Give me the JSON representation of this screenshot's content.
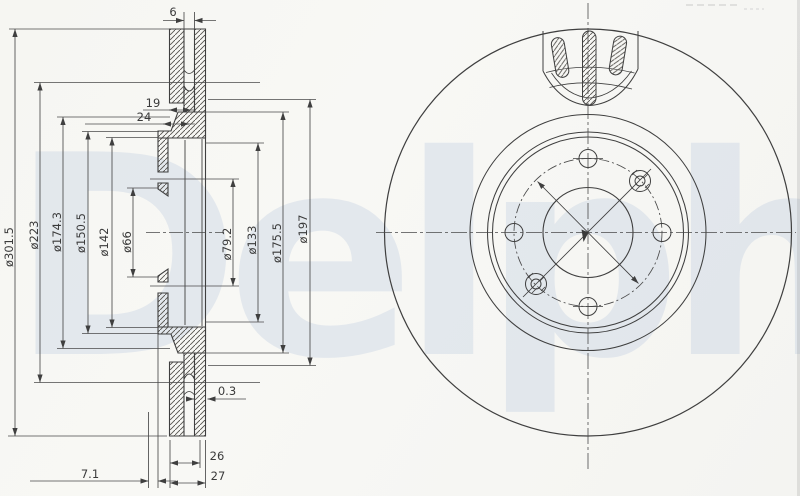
{
  "watermark": {
    "text": "Delphi",
    "color": "#bccadf"
  },
  "section_view": {
    "left_dims": [
      "ø301.5",
      "ø223",
      "ø174.3",
      "ø150.5",
      "ø142",
      "ø66"
    ],
    "right_dims": [
      "ø79.2",
      "ø133",
      "ø175.5",
      "ø197"
    ],
    "top_dims": [
      "6",
      "19",
      "24"
    ],
    "bottom_dims": [
      "0.3",
      "26",
      "27",
      "7.1"
    ]
  },
  "line_color": "#3f3f3f"
}
